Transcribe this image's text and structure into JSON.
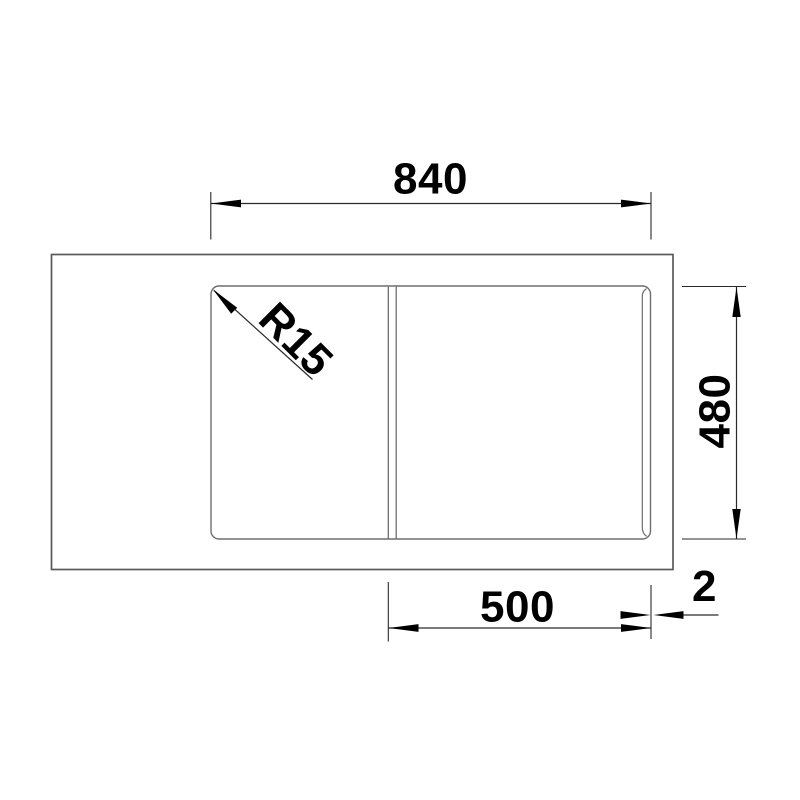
{
  "colors": {
    "background": "#ffffff",
    "dimension_ink": "#000000",
    "dimension_line": "#2a2a2a",
    "outer_outline": "#5a5a5a",
    "inner_outline": "#6e6e6e"
  },
  "dimensions": {
    "overall_width": {
      "label": "840"
    },
    "overall_depth": {
      "label": "480"
    },
    "bowl_width": {
      "label": "500"
    },
    "edge_offset": {
      "label": "2"
    },
    "corner_radius": {
      "label": "R15"
    }
  }
}
